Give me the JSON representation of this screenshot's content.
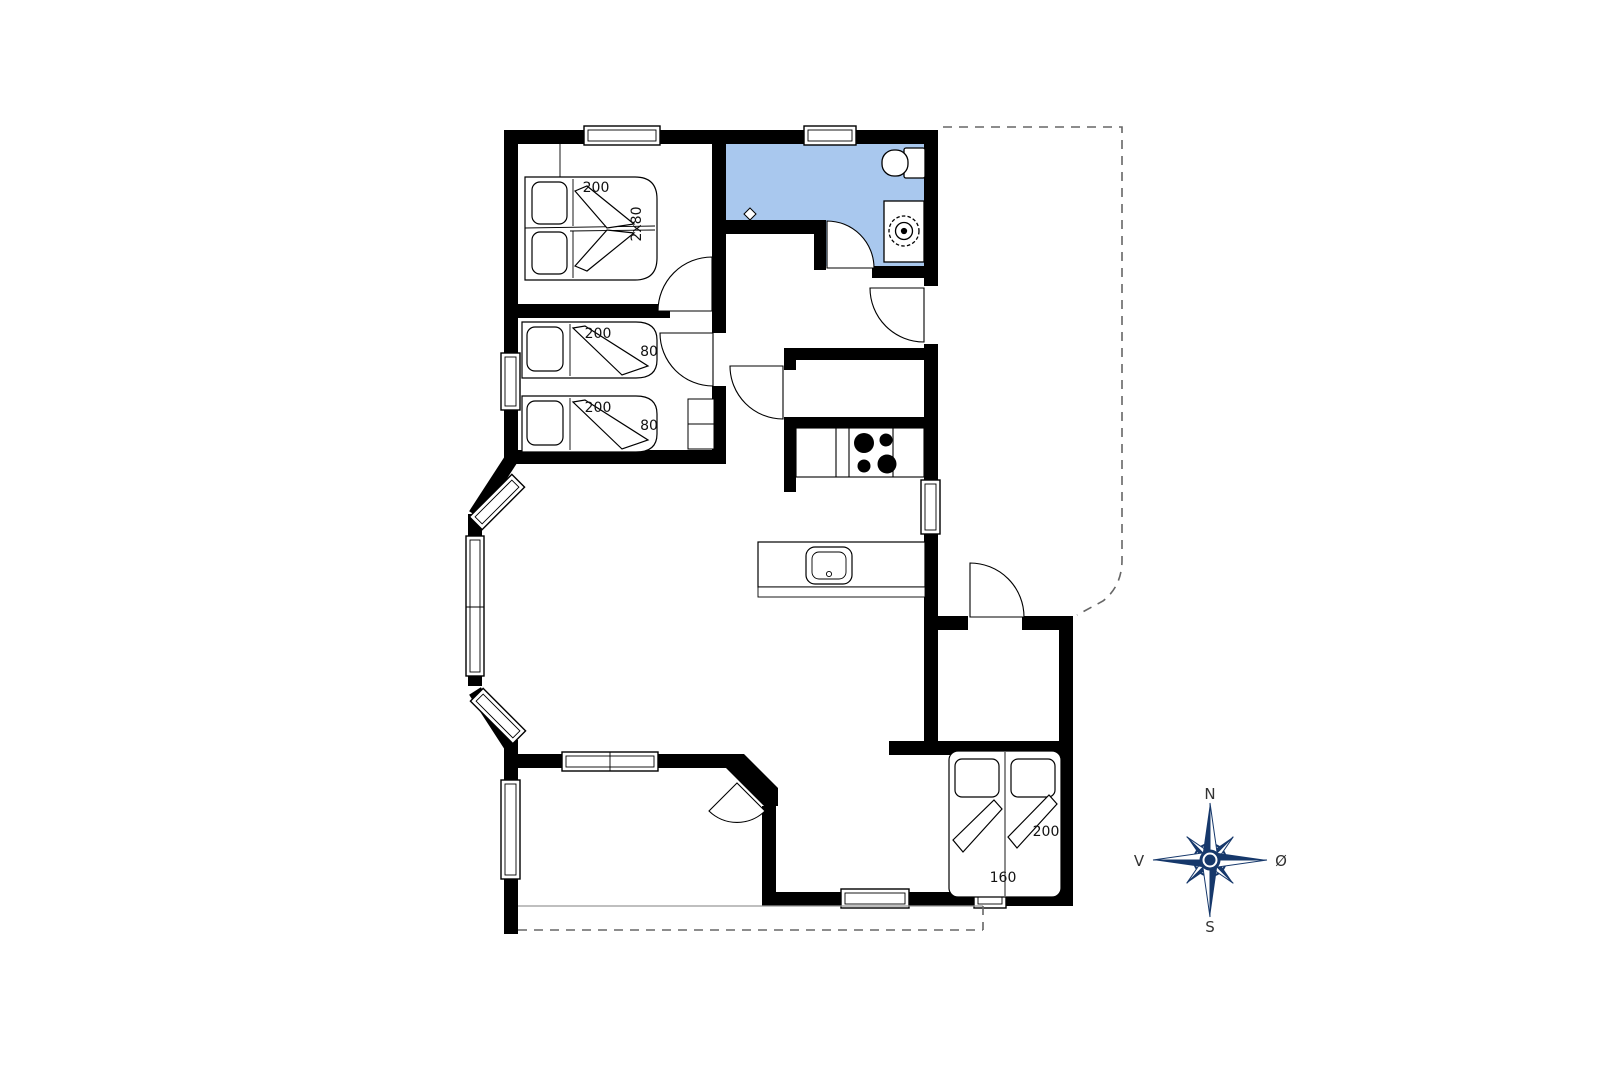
{
  "floor_plan": {
    "colors": {
      "wall": "#000000",
      "bathroom_floor": "#a9c8ee",
      "line": "#000000",
      "thin_line": "#999999",
      "dashed_line": "#666666"
    },
    "labels": {
      "bedroom1_bed_length": "200",
      "bedroom1_bed_width": "2x80",
      "bedroom2_bed1_length": "200",
      "bedroom2_bed1_width": "80",
      "bedroom2_bed2_length": "200",
      "bedroom2_bed2_width": "80",
      "bedroom3_bed_length": "200",
      "bedroom3_bed_width": "160"
    },
    "compass": {
      "north": "N",
      "south": "S",
      "west": "V",
      "east": "Ø",
      "color": "#16386b",
      "letter_color": "#333333"
    }
  }
}
